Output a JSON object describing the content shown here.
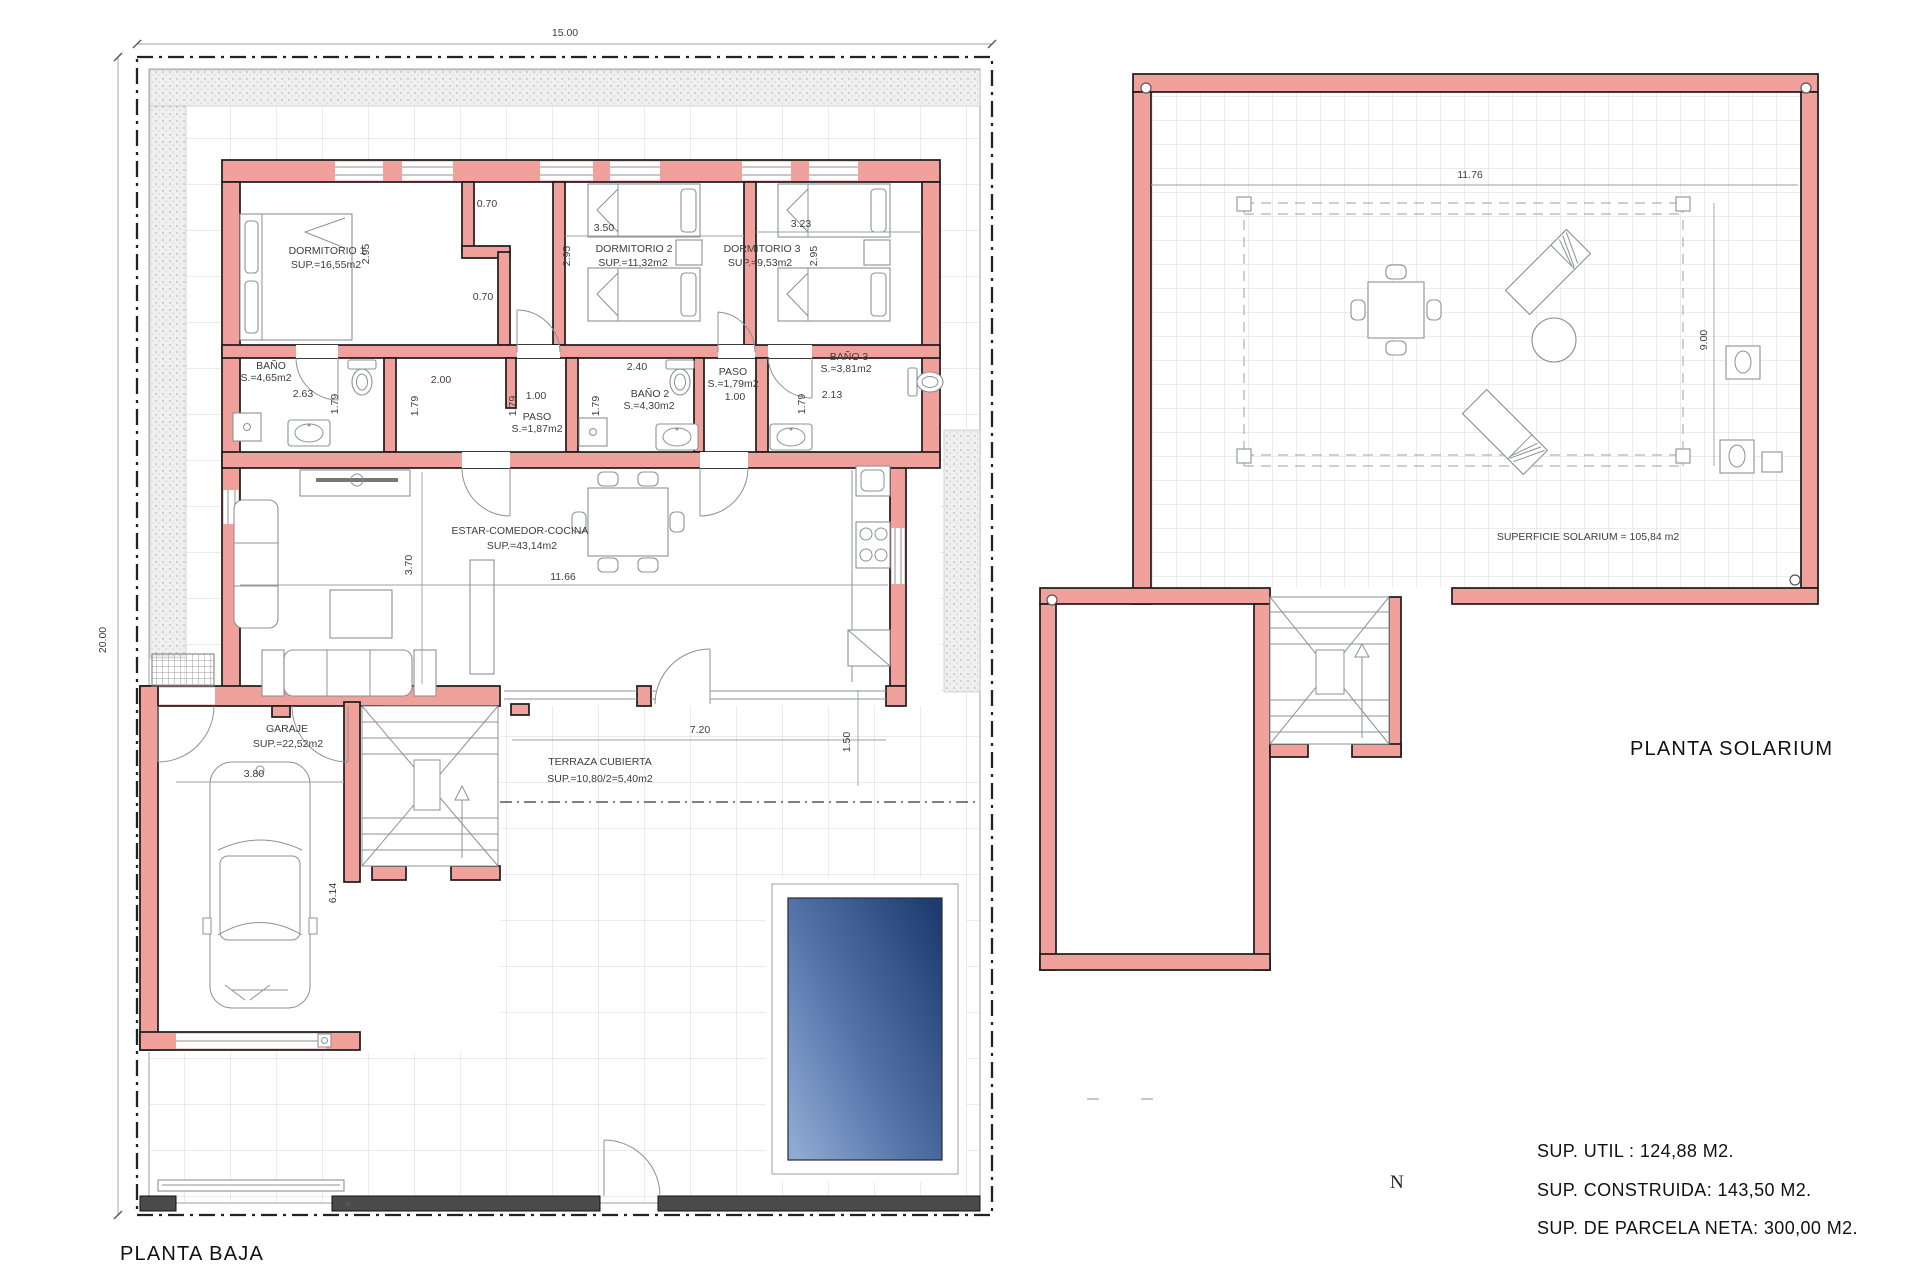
{
  "baja": {
    "title": "PLANTA BAJA",
    "rooms": [
      {
        "name": "DORMITORIO 1",
        "area": "SUP.=16,55m2"
      },
      {
        "name": "DORMITORIO 2",
        "area": "SUP.=11,32m2"
      },
      {
        "name": "DORMITORIO 3",
        "area": "SUP.=9,53m2"
      },
      {
        "name": "BAÑO",
        "area": "S.=4,65m2"
      },
      {
        "name": "PASO",
        "area": "S.=1,87m2"
      },
      {
        "name": "BAÑO 2",
        "area": "S.=4,30m2"
      },
      {
        "name": "PASO",
        "area": "S.=1,79m2"
      },
      {
        "name": "BAÑO 3",
        "area": "S.=3,81m2"
      },
      {
        "name": "ESTAR-COMEDOR-COCINA",
        "area": "SUP.=43,14m2"
      },
      {
        "name": "GARAJE",
        "area": "SUP.=22,52m2"
      },
      {
        "name": "TERRAZA CUBIERTA",
        "area": "SUP.=10,80/2=5,40m2"
      }
    ],
    "dims": {
      "plot_w": "15.00",
      "plot_h": "20.00",
      "dorm1_h": "2.95",
      "nook_top": "0.70",
      "nook_bottom": "0.70",
      "dorm2_w": "3.50",
      "dorm2_h": "2.95",
      "dorm3_w": "3.23",
      "dorm3_h": "2.95",
      "bano1_w": "2.63",
      "bano1_h": "1.79",
      "paso1_w": "2.00",
      "paso1_h": "1.79",
      "paso1_w2": "1.00",
      "paso1_h2": "1.79",
      "bano2_w": "2.40",
      "bano2_h": "1.79",
      "paso2_w": "1.00",
      "paso2_h": "1.79",
      "bano3_w": "2.13",
      "salon_h": "3.70",
      "salon_w": "11.66",
      "garaje_w": "3.80",
      "garaje_h": "6.14",
      "terraza_w": "7.20",
      "terraza_h": "1.50"
    }
  },
  "solarium": {
    "title": "PLANTA SOLARIUM",
    "surface_label": "SUPERFICIE SOLARIUM = 105,84 m2",
    "dims": {
      "w": "11.76",
      "h": "9.00"
    }
  },
  "summary": {
    "util": "SUP. UTIL : 124,88 M2.",
    "construida": "SUP. CONSTRUIDA: 143,50 M2.",
    "parcela": "SUP. DE PARCELA NETA: 300,00 M2."
  },
  "compass": {
    "north": "N"
  },
  "colors": {
    "wall": "#f1a19c",
    "pool_dark": "#1f3c70",
    "pool_light": "#8ea9d2"
  }
}
